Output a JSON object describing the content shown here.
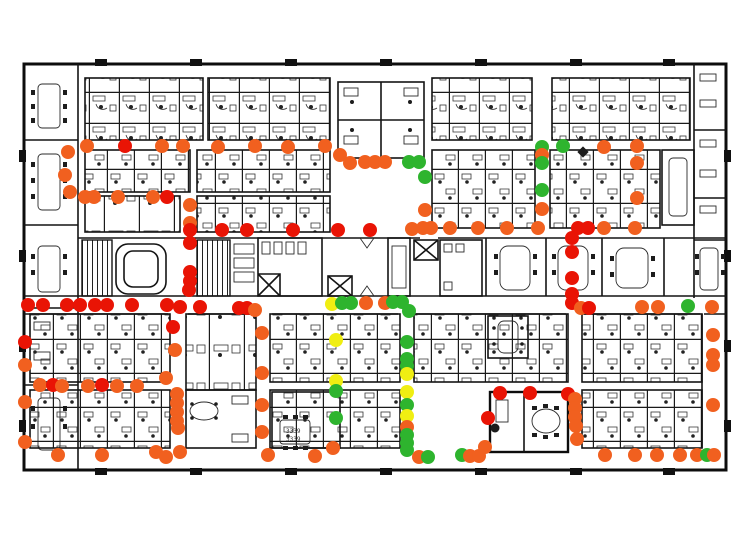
{
  "figure": {
    "description": "Office floor plan with colored sensor status dots",
    "width": 748,
    "height": 545
  },
  "colors": {
    "red": "#e91405",
    "orange": "#f1601f",
    "green": "#2eb42e",
    "yellow": "#f0ee12"
  },
  "dot_radius": 7,
  "room_labels": [
    {
      "text": "3339",
      "x": 286,
      "y": 433
    },
    {
      "text": "3339",
      "x": 286,
      "y": 441
    }
  ],
  "dots": [
    {
      "x": 87,
      "y": 146,
      "c": "orange"
    },
    {
      "x": 125,
      "y": 146,
      "c": "red"
    },
    {
      "x": 162,
      "y": 146,
      "c": "orange"
    },
    {
      "x": 183,
      "y": 146,
      "c": "orange"
    },
    {
      "x": 218,
      "y": 147,
      "c": "orange"
    },
    {
      "x": 255,
      "y": 146,
      "c": "orange"
    },
    {
      "x": 288,
      "y": 147,
      "c": "orange"
    },
    {
      "x": 325,
      "y": 146,
      "c": "orange"
    },
    {
      "x": 68,
      "y": 152,
      "c": "orange"
    },
    {
      "x": 65,
      "y": 175,
      "c": "orange"
    },
    {
      "x": 70,
      "y": 192,
      "c": "orange"
    },
    {
      "x": 340,
      "y": 155,
      "c": "orange"
    },
    {
      "x": 350,
      "y": 163,
      "c": "orange"
    },
    {
      "x": 365,
      "y": 162,
      "c": "orange"
    },
    {
      "x": 375,
      "y": 162,
      "c": "orange"
    },
    {
      "x": 385,
      "y": 162,
      "c": "orange"
    },
    {
      "x": 409,
      "y": 162,
      "c": "green"
    },
    {
      "x": 419,
      "y": 162,
      "c": "green"
    },
    {
      "x": 425,
      "y": 177,
      "c": "green"
    },
    {
      "x": 85,
      "y": 197,
      "c": "orange"
    },
    {
      "x": 94,
      "y": 197,
      "c": "orange"
    },
    {
      "x": 118,
      "y": 197,
      "c": "orange"
    },
    {
      "x": 153,
      "y": 197,
      "c": "orange"
    },
    {
      "x": 167,
      "y": 197,
      "c": "red"
    },
    {
      "x": 190,
      "y": 205,
      "c": "orange"
    },
    {
      "x": 190,
      "y": 223,
      "c": "orange"
    },
    {
      "x": 190,
      "y": 230,
      "c": "red"
    },
    {
      "x": 190,
      "y": 243,
      "c": "red"
    },
    {
      "x": 190,
      "y": 272,
      "c": "red"
    },
    {
      "x": 190,
      "y": 281,
      "c": "red"
    },
    {
      "x": 189,
      "y": 290,
      "c": "red"
    },
    {
      "x": 222,
      "y": 230,
      "c": "red"
    },
    {
      "x": 247,
      "y": 230,
      "c": "red"
    },
    {
      "x": 293,
      "y": 230,
      "c": "red"
    },
    {
      "x": 338,
      "y": 230,
      "c": "red"
    },
    {
      "x": 370,
      "y": 230,
      "c": "red"
    },
    {
      "x": 412,
      "y": 229,
      "c": "orange"
    },
    {
      "x": 423,
      "y": 228,
      "c": "orange"
    },
    {
      "x": 431,
      "y": 228,
      "c": "orange"
    },
    {
      "x": 450,
      "y": 228,
      "c": "orange"
    },
    {
      "x": 478,
      "y": 228,
      "c": "orange"
    },
    {
      "x": 507,
      "y": 228,
      "c": "orange"
    },
    {
      "x": 538,
      "y": 228,
      "c": "orange"
    },
    {
      "x": 578,
      "y": 228,
      "c": "red"
    },
    {
      "x": 588,
      "y": 228,
      "c": "red"
    },
    {
      "x": 604,
      "y": 228,
      "c": "orange"
    },
    {
      "x": 635,
      "y": 228,
      "c": "orange"
    },
    {
      "x": 542,
      "y": 147,
      "c": "green"
    },
    {
      "x": 542,
      "y": 155,
      "c": "orange"
    },
    {
      "x": 542,
      "y": 163,
      "c": "green"
    },
    {
      "x": 563,
      "y": 146,
      "c": "green"
    },
    {
      "x": 542,
      "y": 190,
      "c": "green"
    },
    {
      "x": 604,
      "y": 147,
      "c": "orange"
    },
    {
      "x": 637,
      "y": 146,
      "c": "orange"
    },
    {
      "x": 637,
      "y": 163,
      "c": "orange"
    },
    {
      "x": 637,
      "y": 198,
      "c": "orange"
    },
    {
      "x": 425,
      "y": 210,
      "c": "orange"
    },
    {
      "x": 542,
      "y": 209,
      "c": "orange"
    },
    {
      "x": 572,
      "y": 238,
      "c": "red"
    },
    {
      "x": 572,
      "y": 252,
      "c": "red"
    },
    {
      "x": 572,
      "y": 278,
      "c": "red"
    },
    {
      "x": 572,
      "y": 294,
      "c": "red"
    },
    {
      "x": 572,
      "y": 303,
      "c": "red"
    },
    {
      "x": 581,
      "y": 308,
      "c": "orange"
    },
    {
      "x": 589,
      "y": 308,
      "c": "red"
    },
    {
      "x": 28,
      "y": 305,
      "c": "red"
    },
    {
      "x": 43,
      "y": 305,
      "c": "red"
    },
    {
      "x": 67,
      "y": 305,
      "c": "red"
    },
    {
      "x": 80,
      "y": 305,
      "c": "red"
    },
    {
      "x": 95,
      "y": 305,
      "c": "red"
    },
    {
      "x": 107,
      "y": 305,
      "c": "red"
    },
    {
      "x": 132,
      "y": 305,
      "c": "red"
    },
    {
      "x": 167,
      "y": 305,
      "c": "red"
    },
    {
      "x": 180,
      "y": 307,
      "c": "red"
    },
    {
      "x": 200,
      "y": 307,
      "c": "red"
    },
    {
      "x": 239,
      "y": 308,
      "c": "red"
    },
    {
      "x": 247,
      "y": 308,
      "c": "red"
    },
    {
      "x": 255,
      "y": 310,
      "c": "orange"
    },
    {
      "x": 332,
      "y": 304,
      "c": "yellow"
    },
    {
      "x": 342,
      "y": 303,
      "c": "green"
    },
    {
      "x": 351,
      "y": 303,
      "c": "green"
    },
    {
      "x": 366,
      "y": 303,
      "c": "orange"
    },
    {
      "x": 385,
      "y": 303,
      "c": "orange"
    },
    {
      "x": 393,
      "y": 302,
      "c": "green"
    },
    {
      "x": 402,
      "y": 302,
      "c": "green"
    },
    {
      "x": 409,
      "y": 311,
      "c": "green"
    },
    {
      "x": 642,
      "y": 307,
      "c": "orange"
    },
    {
      "x": 658,
      "y": 307,
      "c": "orange"
    },
    {
      "x": 688,
      "y": 306,
      "c": "green"
    },
    {
      "x": 712,
      "y": 307,
      "c": "orange"
    },
    {
      "x": 173,
      "y": 327,
      "c": "red"
    },
    {
      "x": 175,
      "y": 350,
      "c": "orange"
    },
    {
      "x": 166,
      "y": 378,
      "c": "orange"
    },
    {
      "x": 177,
      "y": 394,
      "c": "orange"
    },
    {
      "x": 177,
      "y": 403,
      "c": "orange"
    },
    {
      "x": 177,
      "y": 412,
      "c": "orange"
    },
    {
      "x": 177,
      "y": 421,
      "c": "orange"
    },
    {
      "x": 178,
      "y": 428,
      "c": "orange"
    },
    {
      "x": 180,
      "y": 452,
      "c": "orange"
    },
    {
      "x": 25,
      "y": 342,
      "c": "red"
    },
    {
      "x": 25,
      "y": 365,
      "c": "orange"
    },
    {
      "x": 25,
      "y": 402,
      "c": "orange"
    },
    {
      "x": 25,
      "y": 442,
      "c": "orange"
    },
    {
      "x": 40,
      "y": 385,
      "c": "orange"
    },
    {
      "x": 53,
      "y": 385,
      "c": "red"
    },
    {
      "x": 62,
      "y": 386,
      "c": "orange"
    },
    {
      "x": 88,
      "y": 386,
      "c": "orange"
    },
    {
      "x": 102,
      "y": 385,
      "c": "red"
    },
    {
      "x": 117,
      "y": 386,
      "c": "orange"
    },
    {
      "x": 137,
      "y": 386,
      "c": "orange"
    },
    {
      "x": 58,
      "y": 455,
      "c": "orange"
    },
    {
      "x": 102,
      "y": 455,
      "c": "orange"
    },
    {
      "x": 156,
      "y": 452,
      "c": "orange"
    },
    {
      "x": 166,
      "y": 457,
      "c": "orange"
    },
    {
      "x": 262,
      "y": 333,
      "c": "orange"
    },
    {
      "x": 262,
      "y": 373,
      "c": "orange"
    },
    {
      "x": 262,
      "y": 405,
      "c": "orange"
    },
    {
      "x": 262,
      "y": 432,
      "c": "orange"
    },
    {
      "x": 268,
      "y": 455,
      "c": "orange"
    },
    {
      "x": 315,
      "y": 456,
      "c": "orange"
    },
    {
      "x": 336,
      "y": 340,
      "c": "yellow"
    },
    {
      "x": 336,
      "y": 381,
      "c": "yellow"
    },
    {
      "x": 336,
      "y": 391,
      "c": "green"
    },
    {
      "x": 336,
      "y": 418,
      "c": "green"
    },
    {
      "x": 333,
      "y": 448,
      "c": "orange"
    },
    {
      "x": 407,
      "y": 342,
      "c": "green"
    },
    {
      "x": 407,
      "y": 359,
      "c": "green"
    },
    {
      "x": 407,
      "y": 366,
      "c": "green"
    },
    {
      "x": 407,
      "y": 374,
      "c": "yellow"
    },
    {
      "x": 407,
      "y": 392,
      "c": "yellow"
    },
    {
      "x": 407,
      "y": 405,
      "c": "green"
    },
    {
      "x": 407,
      "y": 416,
      "c": "yellow"
    },
    {
      "x": 407,
      "y": 427,
      "c": "orange"
    },
    {
      "x": 407,
      "y": 435,
      "c": "green"
    },
    {
      "x": 407,
      "y": 443,
      "c": "green"
    },
    {
      "x": 407,
      "y": 450,
      "c": "green"
    },
    {
      "x": 419,
      "y": 457,
      "c": "orange"
    },
    {
      "x": 428,
      "y": 457,
      "c": "green"
    },
    {
      "x": 713,
      "y": 335,
      "c": "orange"
    },
    {
      "x": 713,
      "y": 355,
      "c": "orange"
    },
    {
      "x": 713,
      "y": 365,
      "c": "orange"
    },
    {
      "x": 713,
      "y": 405,
      "c": "orange"
    },
    {
      "x": 500,
      "y": 393,
      "c": "red"
    },
    {
      "x": 530,
      "y": 393,
      "c": "red"
    },
    {
      "x": 568,
      "y": 394,
      "c": "red"
    },
    {
      "x": 575,
      "y": 399,
      "c": "orange"
    },
    {
      "x": 575,
      "y": 408,
      "c": "orange"
    },
    {
      "x": 575,
      "y": 417,
      "c": "orange"
    },
    {
      "x": 576,
      "y": 426,
      "c": "orange"
    },
    {
      "x": 488,
      "y": 418,
      "c": "red"
    },
    {
      "x": 485,
      "y": 447,
      "c": "orange"
    },
    {
      "x": 462,
      "y": 455,
      "c": "green"
    },
    {
      "x": 470,
      "y": 456,
      "c": "orange"
    },
    {
      "x": 479,
      "y": 456,
      "c": "orange"
    },
    {
      "x": 577,
      "y": 439,
      "c": "orange"
    },
    {
      "x": 605,
      "y": 455,
      "c": "orange"
    },
    {
      "x": 635,
      "y": 455,
      "c": "orange"
    },
    {
      "x": 657,
      "y": 455,
      "c": "orange"
    },
    {
      "x": 680,
      "y": 455,
      "c": "orange"
    },
    {
      "x": 697,
      "y": 455,
      "c": "orange"
    },
    {
      "x": 707,
      "y": 455,
      "c": "green"
    },
    {
      "x": 714,
      "y": 455,
      "c": "orange"
    }
  ]
}
